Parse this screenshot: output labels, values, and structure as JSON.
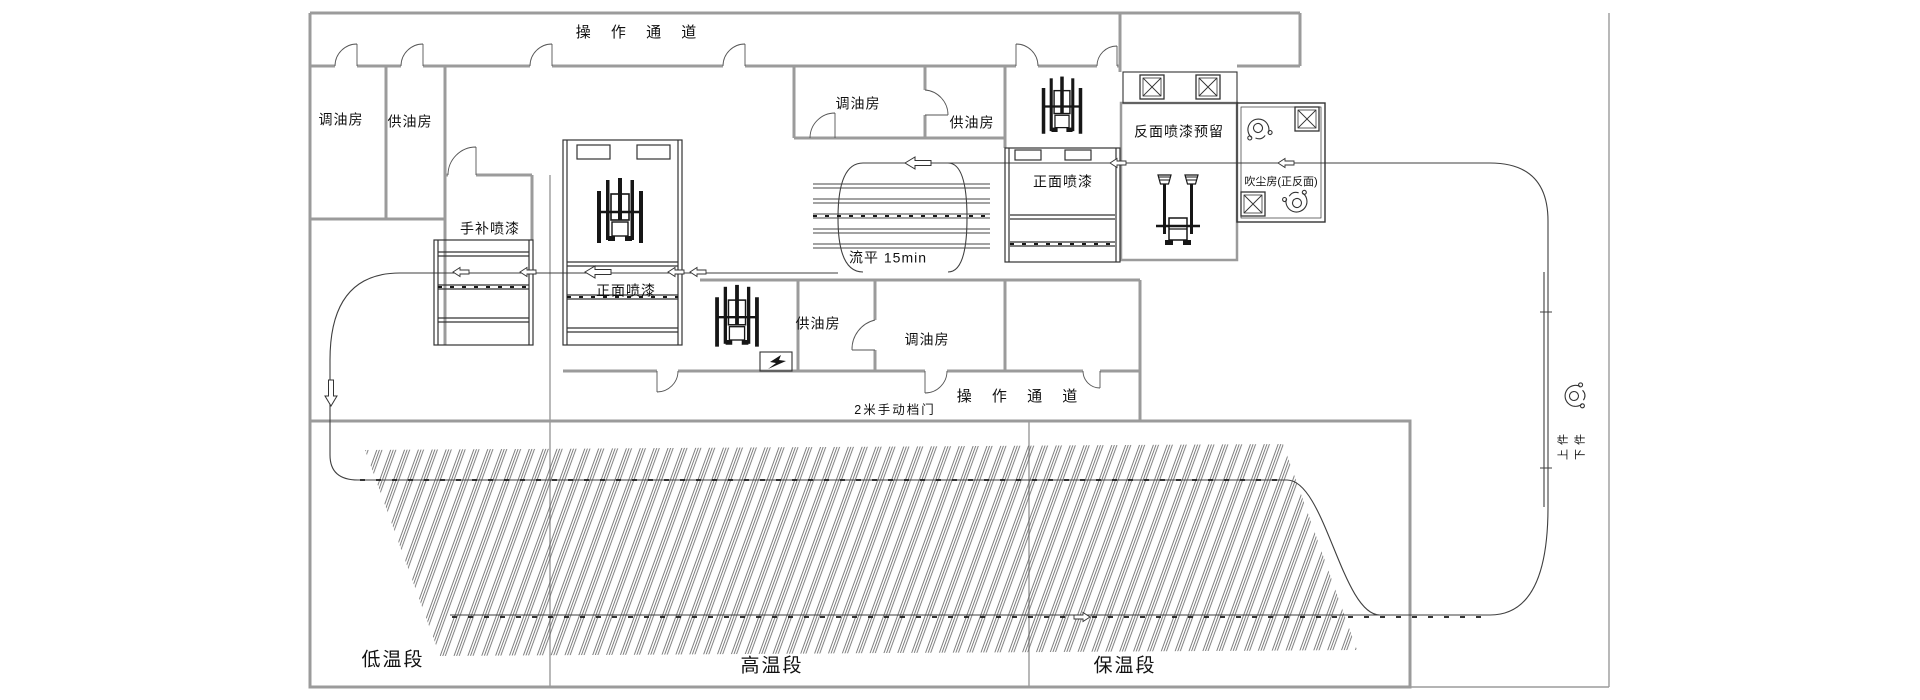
{
  "colors": {
    "wall": "#9b9b9b",
    "line": "#3f3f3f",
    "equip": "#161616",
    "thin": "#555555",
    "bg": "#ffffff"
  },
  "corridors": {
    "top_label": "操 作 通 道",
    "bottom_label": "操 作 通 道"
  },
  "rooms": {
    "mixing_left": "调油房",
    "supply_left": "供油房",
    "touch_up": "手补喷漆",
    "front_spray_left": "正面喷漆",
    "mixing_mid": "调油房",
    "supply_mid": "供油房",
    "front_spray_right": "正面喷漆",
    "back_spray_reserved": "反面喷漆预留",
    "dust_room": "吹尘房(正反面)",
    "supply_lower": "供油房",
    "mixing_lower": "调油房"
  },
  "process": {
    "leveling": "流平 15min",
    "manual_door": "2米手动档门"
  },
  "oven_sections": {
    "low": "低温段",
    "high": "高温段",
    "hold": "保温段"
  },
  "station": {
    "load": "上件",
    "unload": "下件"
  },
  "icons": {
    "spray_robot": "paint-robot machine glyph",
    "fan_filter": "square-with-X filter unit",
    "worker": "top-view person figure",
    "power": "lightning-bolt",
    "flow_arrow": "hollow flow arrow"
  }
}
